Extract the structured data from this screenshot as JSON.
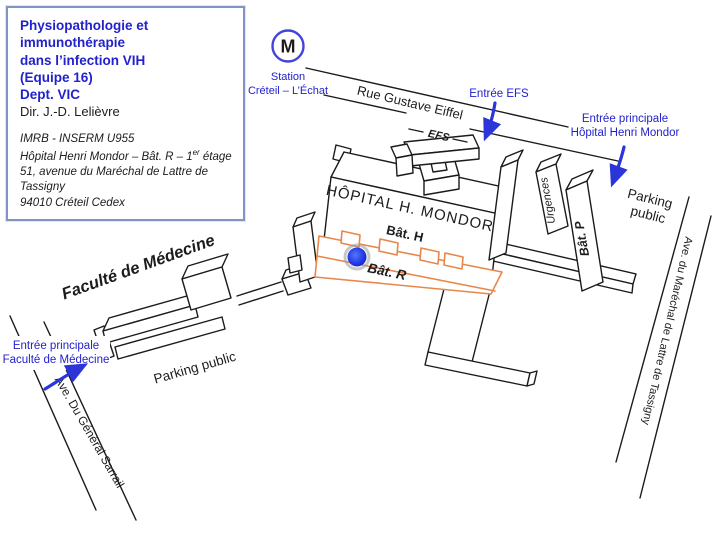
{
  "info_box": {
    "line1": "Physiopathologie et immunothérapie",
    "line2": "dans l’infection VIH",
    "line3": "(Equipe 16)",
    "line4": "Dept. VIC",
    "director": "Dir. J.-D. Lelièvre",
    "org": "IMRB - INSERM U955",
    "addr1_pre": "Hôpital Henri Mondor – Bât. R – 1",
    "addr1_sup": "er",
    "addr1_post": " étage",
    "addr2": "51, avenue du Maréchal de Lattre de Tassigny",
    "addr3": "94010 Créteil Cedex"
  },
  "metro": {
    "letter": "M",
    "station_line1": "Station",
    "station_line2": "Créteil – L’Échat"
  },
  "streets": {
    "eiffel": "Rue Gustave Eiffel",
    "sarrail": "Ave. Du Général Sarrail",
    "lattre": "Ave. du Maréchal de Lattre de Tassigny"
  },
  "buildings": {
    "hospital": "HÔPITAL H. MONDOR",
    "bat_h": "Bât. H",
    "bat_r": "Bât. R",
    "bat_p": "Bât. P",
    "efs": "EFS",
    "urgences": "Urgences",
    "faculte": "Faculté de Médecine"
  },
  "parking": {
    "right_line1": "Parking",
    "right_line2": "public",
    "left": "Parking public"
  },
  "entrances": {
    "efs": "Entrée EFS",
    "hopital_line1": "Entrée principale",
    "hopital_line2": "Hôpital Henri Mondor",
    "faculte_line1": "Entrée principale",
    "faculte_line2": "Faculté de Médecine"
  },
  "colors": {
    "blue_text": "#2222cc",
    "arrow_blue": "#2b35d8",
    "orange_outline": "#e8874a",
    "orange_text": "#de6b26",
    "line_black": "#1b1b1b",
    "dot_blue_center": "#5577ff",
    "dot_blue_edge": "#1225c9"
  }
}
